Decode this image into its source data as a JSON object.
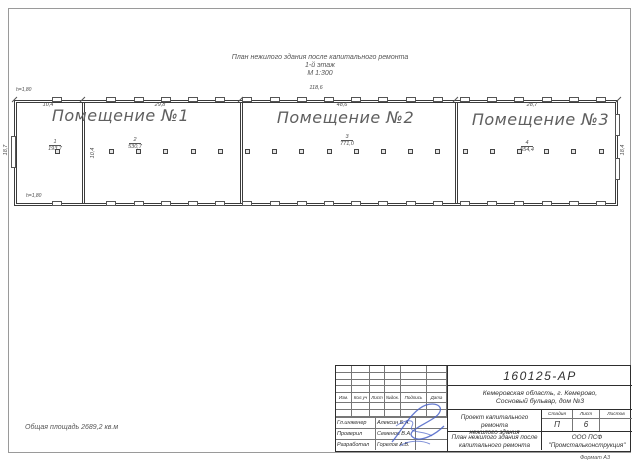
{
  "sheet": {
    "title_lines": [
      "План нежилого здания после капитального ремонта",
      "1-й этаж",
      "М 1:300"
    ],
    "total_area_note": "Общая площадь 2689,2 кв.м",
    "format_note": "Формат А3"
  },
  "plan": {
    "rooms": [
      {
        "label": "Помещение №1"
      },
      {
        "label": "Помещение №2"
      },
      {
        "label": "Помещение №3"
      }
    ],
    "area_markers": [
      {
        "num": "1",
        "area": "193,7"
      },
      {
        "num": "2",
        "area": "530,7"
      },
      {
        "num": "3",
        "area": "771,0"
      },
      {
        "num": "4",
        "area": "554,4"
      }
    ],
    "dims": {
      "overall_top": "118,6",
      "top_segments": [
        "10,4",
        "29,8",
        "48,6",
        "28,7"
      ],
      "left": "18,7",
      "right": "18,4",
      "partition": "10,4",
      "height_marks": [
        "h=1,80",
        "h=1,80"
      ]
    }
  },
  "title_block": {
    "doc_number": "160125-АР",
    "address_line1": "Кемеровская область, г. Кемерово,",
    "address_line2": "Сосновый бульвар, дом №3",
    "project_line1": "Проект капитального ремонта",
    "project_line2": "нежилого здания",
    "sheet_title_line1": "План нежилого здания после",
    "sheet_title_line2": "капитального ремонта",
    "company_line1": "ООО ПСФ",
    "company_line2": "\"Промстальконструкция\"",
    "stage_header": [
      "Стадия",
      "Лист",
      "Листов"
    ],
    "stage_values": [
      "П",
      "6",
      ""
    ],
    "revision_header": [
      "Изм.",
      "Кол.уч",
      "Лист",
      "№док.",
      "Подпись",
      "Дата"
    ],
    "signers": [
      {
        "role": "Гл.инженер",
        "name": "Алексин Б.А."
      },
      {
        "role": "Проверил",
        "name": "Семенов В.А."
      },
      {
        "role": "Разработал",
        "name": "Горелов А.В."
      }
    ],
    "colors": {
      "signature_ink": "#4a63c8",
      "line": "#3c3c3c"
    }
  }
}
